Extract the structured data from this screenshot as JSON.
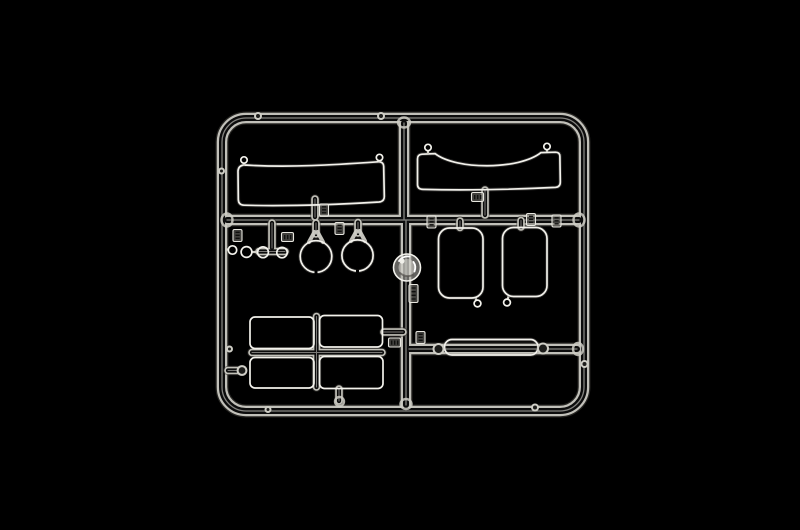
{
  "scene": {
    "type": "product-photograph",
    "description": "Clear transparent injection-molded model kit sprue (clear-parts tree) with windscreens, round lamp lenses, window panes and a light strip, photographed on a black background",
    "background_color": "#000000",
    "colors": {
      "plastic_bright": "#f3f2ec",
      "plastic_mid": "#cfcec6",
      "plastic_faint": "#e7e6df",
      "plastic_core": "#0c0c0c"
    }
  },
  "sprue": {
    "material": "clear styrene",
    "frame_shape": "rounded-rectangle",
    "parts": [
      {
        "name": "wide-windscreen",
        "location": "top-left",
        "count": 1,
        "shape": "long shallow rectangle with two corner attachment rings"
      },
      {
        "name": "curved-windscreen",
        "location": "top-right",
        "count": 1,
        "shape": "rectangle with concave curved top edge and two corner attachment rings"
      },
      {
        "name": "small-round-lens",
        "location": "middle-left",
        "count": 4,
        "shape": "small circular lenses in a row"
      },
      {
        "name": "headlamp-lens",
        "location": "middle-left",
        "count": 2,
        "shape": "large circular lenses with forked feeds"
      },
      {
        "name": "side-window",
        "location": "middle-right",
        "count": 2,
        "shape": "tall rounded-rectangle panes with corner dot"
      },
      {
        "name": "window-pane",
        "location": "bottom-left",
        "count": 4,
        "shape": "2x2 grid of rectangular panes around a cross runner"
      },
      {
        "name": "light-bar-strip",
        "location": "bottom-right",
        "count": 1,
        "shape": "narrow pill-shaped strip between two round bosses"
      },
      {
        "name": "injection-gate",
        "location": "center",
        "count": 1,
        "shape": "round frosted gate boss on the central runner"
      }
    ],
    "part_number_tabs": {
      "count": 11,
      "text_legible": false
    }
  }
}
